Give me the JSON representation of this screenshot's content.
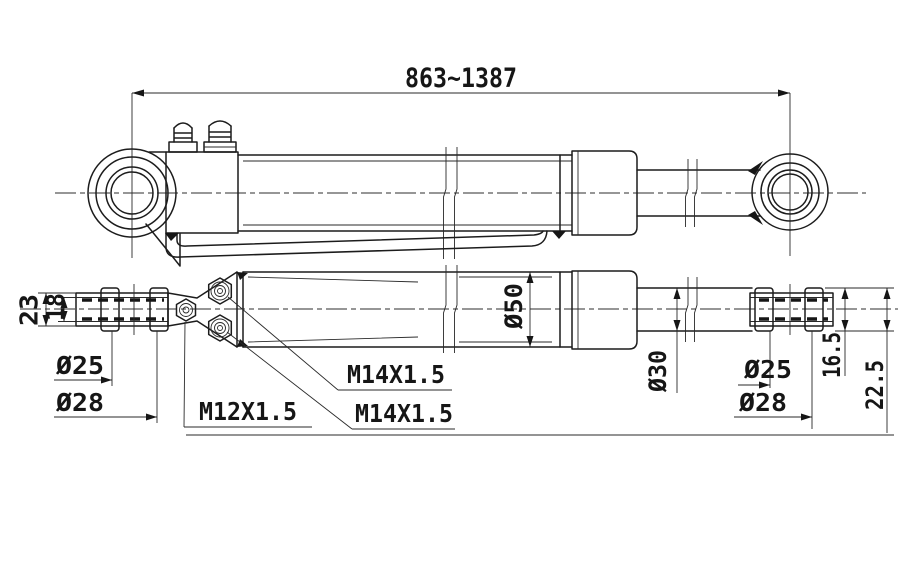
{
  "drawing": {
    "kind": "hydraulic-cylinder-engineering-drawing",
    "line_color": "#1c1c1c",
    "background": "#ffffff",
    "dims": {
      "overall_length": "863~1387",
      "bore_diameter": "Ø50",
      "rod_diameter": "Ø30"
    },
    "left_eye": {
      "outer_width": "23",
      "inner_width": "18",
      "pin_bore": "Ø25",
      "bushing_od": "Ø28"
    },
    "right_eye": {
      "pin_bore": "Ø25",
      "bushing_od": "Ø28",
      "dim_a": "16.5",
      "dim_b": "22.5"
    },
    "threads": {
      "grease_fitting": "M12X1.5",
      "port_upper": "M14X1.5",
      "port_lower": "M14X1.5"
    }
  }
}
